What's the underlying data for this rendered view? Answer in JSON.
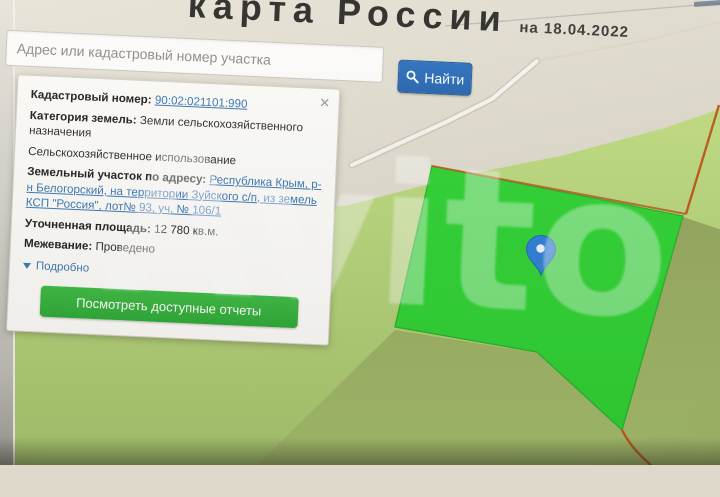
{
  "header": {
    "title": "карта России",
    "date": "на 18.04.2022"
  },
  "search": {
    "placeholder": "Адрес или кадастровый номер участка",
    "button": "Найти"
  },
  "panel": {
    "close": "×",
    "fields": [
      {
        "label": "Кадастровый номер:",
        "value": "90:02:021101:990"
      },
      {
        "label": "Категория земель:",
        "value": "Земли сельскохозяйственного назначения"
      },
      {
        "label": "",
        "value": "Сельскохозяйственное использование"
      },
      {
        "label": "Земельный участок по адресу:",
        "value": "Республика Крым, р-н Белогорский, на территории Зуйского с/п, из земель КСП \"Россия\", лот№ 93, уч. № 106/1"
      },
      {
        "label": "Уточненная площадь:",
        "value": "12 780 кв.м."
      },
      {
        "label": "Межевание:",
        "value": "Проведено"
      }
    ],
    "details": "Подробно",
    "report_button": "Посмотреть доступные отчеты"
  },
  "map": {
    "background": "#ded9cb",
    "field_light_top": "#c0dc81",
    "field_light_bottom": "#a9c76f",
    "field_olive_top": "#93a35c",
    "field_olive_bottom": "#a6bf6c",
    "parcel_fill": "#2fd233",
    "parcel_border": "#2ab32e",
    "boundary_color": "#bc5a1e",
    "road_color": "#f7f5ef",
    "marker": "blue-map-pin"
  },
  "watermark": "Avito"
}
